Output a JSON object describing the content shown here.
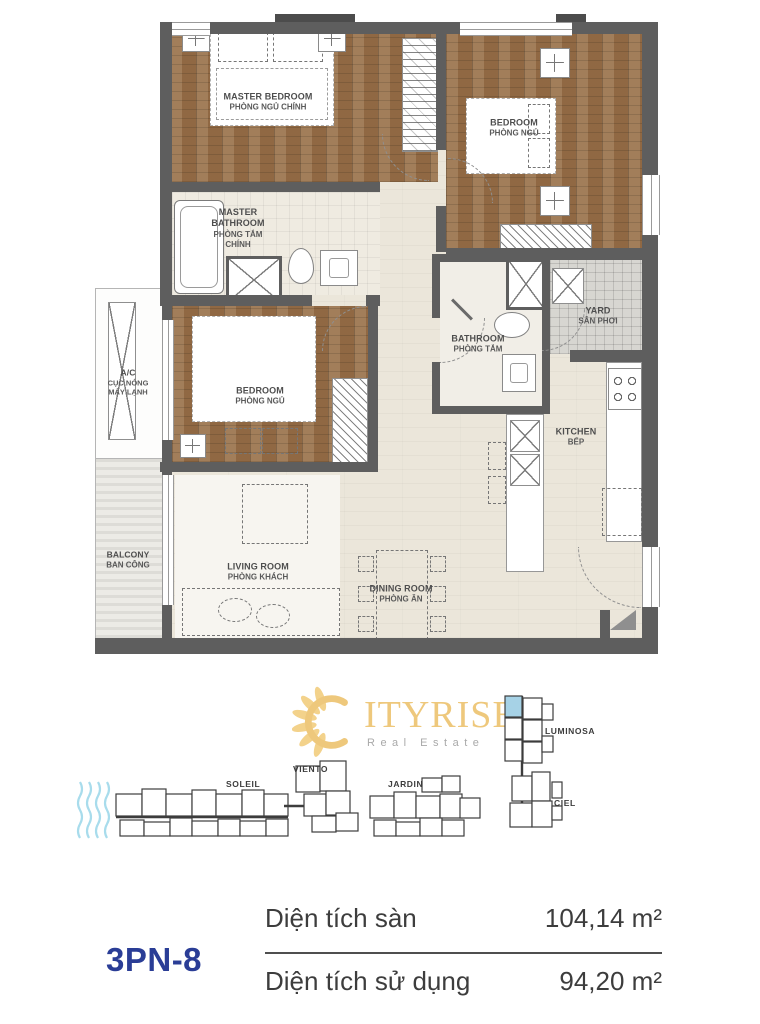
{
  "floor_plan": {
    "rooms": {
      "master_bedroom": {
        "name": "MASTER BEDROOM",
        "name_vi": "PHÒNG NGỦ CHÍNH"
      },
      "bedroom_top": {
        "name": "BEDROOM",
        "name_vi": "PHÒNG NGỦ"
      },
      "master_bathroom": {
        "name": "MASTER BATHROOM",
        "name_vi": "PHÒNG TẮM CHÍNH"
      },
      "bedroom_side": {
        "name": "BEDROOM",
        "name_vi": "PHÒNG NGỦ"
      },
      "bathroom": {
        "name": "BATHROOM",
        "name_vi": "PHÒNG TẮM"
      },
      "yard": {
        "name": "YARD",
        "name_vi": "SÂN PHƠI"
      },
      "kitchen": {
        "name": "KITCHEN",
        "name_vi": "BẾP"
      },
      "living_room": {
        "name": "LIVING ROOM",
        "name_vi": "PHÒNG KHÁCH"
      },
      "dining_room": {
        "name": "DINING ROOM",
        "name_vi": "PHÒNG ĂN"
      },
      "balcony": {
        "name": "BALCONY",
        "name_vi": "BAN CÔNG"
      },
      "ac": {
        "name": "A/C",
        "name_vi_line1": "CỤC NÓNG",
        "name_vi_line2": "MÁY LẠNH"
      }
    }
  },
  "logo": {
    "text": "ITYRISE",
    "subtitle": "Real Estate"
  },
  "site_plan": {
    "buildings": {
      "soleil": "SOLEIL",
      "viento": "VIENTO",
      "jardin": "JARDIN",
      "luminosa": "LUMINOSA",
      "ciel": "CIEL"
    }
  },
  "unit_info": {
    "code": "3PN-8",
    "floor_area_label": "Diện tích sàn",
    "floor_area_value": "104,14 m²",
    "usable_area_label": "Diện tích sử dụng",
    "usable_area_value": "94,20 m²"
  },
  "colors": {
    "logo_gold": "#EEC87C",
    "unit_code_blue": "#2A3D96",
    "highlighted_unit_blue": "#A6D2E6",
    "wood_floor_brown": "#99714A",
    "wall_gray": "#5E5E5E",
    "water_blue": "#A8DCEC"
  }
}
